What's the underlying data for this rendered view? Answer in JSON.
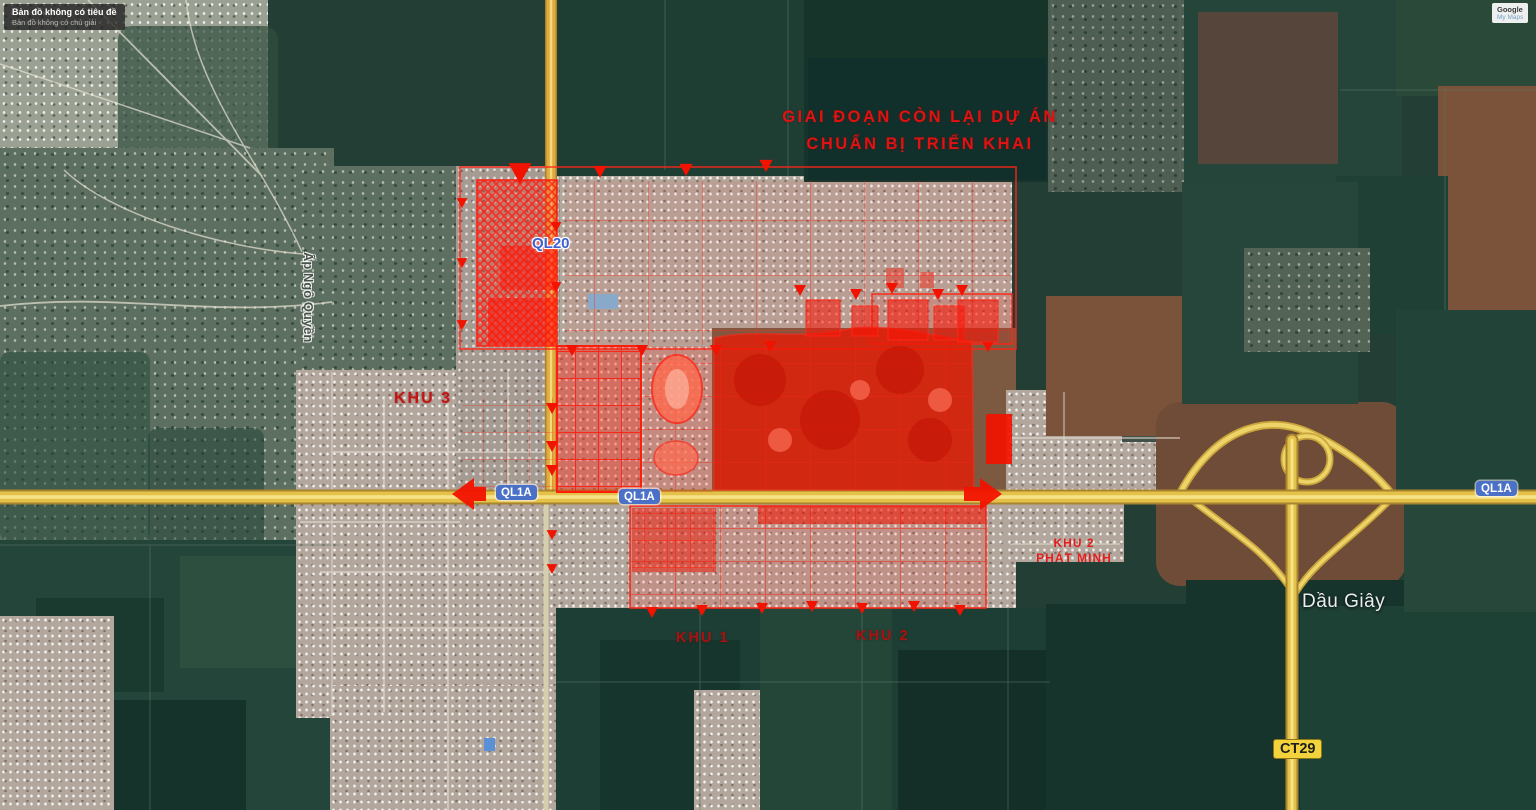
{
  "map": {
    "watermark": {
      "title": "Bản đồ không có tiêu đề",
      "subtitle": "Bản đồ không có chú giải"
    },
    "google_card": {
      "line1": "Google",
      "line2": "My Maps"
    },
    "annotations": {
      "phase_note_line1": "GIAI ĐOẠN CÒN LẠI DỰ ÁN",
      "phase_note_line2": "CHUẨN BỊ TRIỂN KHAI",
      "zone1": "KHU 1",
      "zone2": "KHU 2",
      "zone3": "KHU 3",
      "zone2b_line1": "KHU 2",
      "zone2b_line2": "PHÁT MINH"
    },
    "road_labels": {
      "ql20": "QL20",
      "ql1a": "QL1A",
      "ct29": "CT29"
    },
    "place_labels": {
      "dau_giay": "Dầu Giây",
      "ap_ngo_quyen": "Ấp Ngô Quyền"
    },
    "colors": {
      "overlay_red": "#f21500",
      "label_red": "#e01212",
      "road_yellow": "#e4c24a",
      "badge_blue": "#4a70c8",
      "badge_yellow": "#f2d33b",
      "field_green": "#1d3e34"
    }
  }
}
